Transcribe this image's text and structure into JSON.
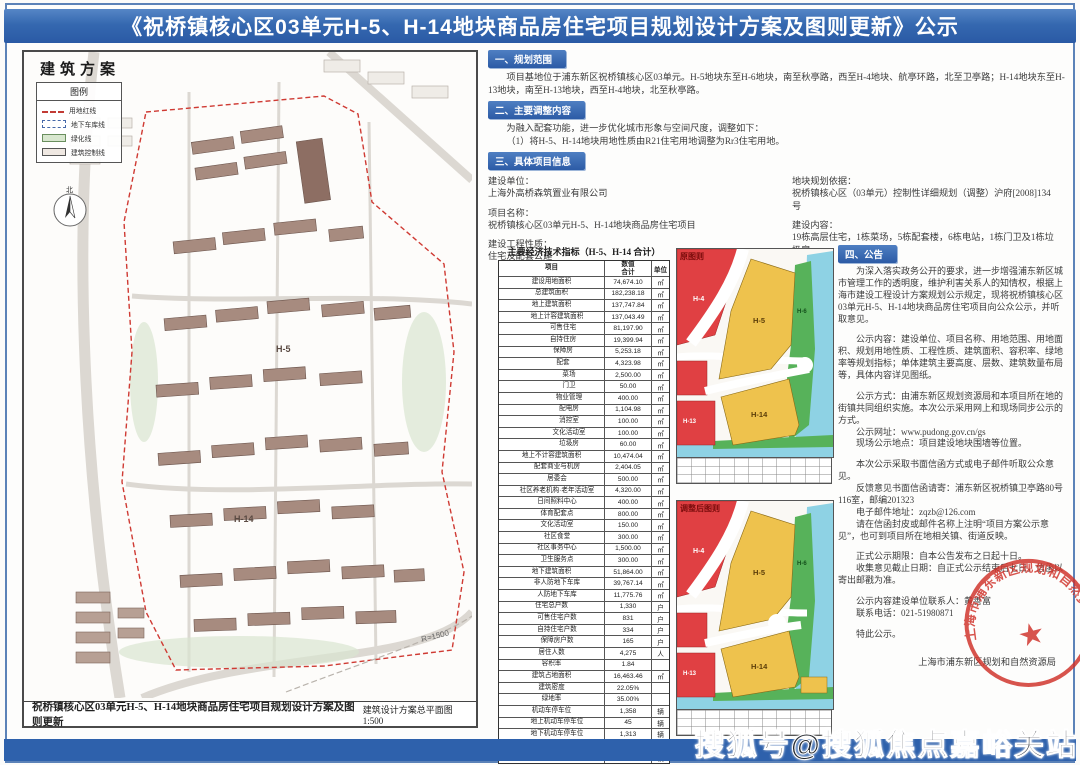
{
  "title": "《祝桥镇核心区03单元H-5、H-14地块商品房住宅项目规划设计方案及图则更新》公示",
  "plan": {
    "heading": "建筑方案",
    "legend_title": "图例",
    "legend_items": [
      {
        "label": "用地红线",
        "cls": "sw-red"
      },
      {
        "label": "地下车库线",
        "cls": "sw-blue"
      },
      {
        "label": "绿化线",
        "cls": "sw-green"
      },
      {
        "label": "建筑控制线",
        "cls": "sw-box"
      }
    ],
    "north_label": "北",
    "radius_label": "R=1500",
    "parcel_h5": "H-5",
    "parcel_h14": "H-14",
    "caption_left": "祝桥镇核心区03单元H-5、H-14地块商品房住宅项目规划设计方案及图则更新",
    "caption_right": "建筑设计方案总平面图 1:500"
  },
  "sections": {
    "s1_heading": "一、规划范围",
    "s1_body": "项目基地位于浦东新区祝桥镇核心区03单元。H-5地块东至H-6地块，南至秋亭路，西至H-4地块、航亭环路，北至卫亭路；H-14地块东至H-13地块，南至H-13地块，西至H-4地块，北至秋亭路。",
    "s2_heading": "二、主要调整内容",
    "s2_line1": "为融入配套功能，进一步优化城市形象与空间尺度，调整如下：",
    "s2_line2": "（1）将H-5、H-14地块用地性质由R21住宅用地调整为Rr3住宅用地。",
    "s3_heading": "三、具体项目信息",
    "s3_left": [
      {
        "label": "建设单位：",
        "value": "上海外高桥森筑置业有限公司"
      },
      {
        "label": "项目名称：",
        "value": "祝桥镇核心区03单元H-5、H-14地块商品房住宅项目"
      },
      {
        "label": "建设工程性质：",
        "value": "住宅及配套公建"
      }
    ],
    "s3_right": [
      {
        "label": "地块规划依据：",
        "value": "祝桥镇核心区（03单元）控制性详细规划（调整）沪府[2008]134号"
      },
      {
        "label": "建设内容：",
        "value": "19栋高层住宅，1栋菜场，5栋配套楼，6栋电站，1栋门卫及1栋垃圾房"
      }
    ],
    "s4_heading": "四、公告"
  },
  "table": {
    "title": "主要经济技术指标（H-5、H-14 合计）",
    "col_item": "项目",
    "col_value": "数值",
    "col_value2": "合计",
    "col_unit": "单位",
    "rows": [
      {
        "n": "建设用地面积",
        "v": "74,674.10",
        "u": "㎡",
        "i": "ind0"
      },
      {
        "n": "总建筑面积",
        "v": "182,238.18",
        "u": "㎡",
        "i": "ind0"
      },
      {
        "n": "地上建筑面积",
        "v": "137,747.84",
        "u": "㎡",
        "i": "ind0"
      },
      {
        "n": "地上计容建筑面积",
        "v": "137,043.49",
        "u": "㎡",
        "i": "ind1"
      },
      {
        "n": "可售住宅",
        "v": "81,197.90",
        "u": "㎡",
        "i": "ind2"
      },
      {
        "n": "自持住房",
        "v": "19,399.94",
        "u": "㎡",
        "i": "ind2"
      },
      {
        "n": "保障房",
        "v": "5,253.18",
        "u": "㎡",
        "i": "ind2"
      },
      {
        "n": "配套",
        "v": "4,323.98",
        "u": "㎡",
        "i": "ind2"
      },
      {
        "n": "菜场",
        "v": "2,500.00",
        "u": "㎡",
        "i": "ind3"
      },
      {
        "n": "门卫",
        "v": "50.00",
        "u": "㎡",
        "i": "ind3"
      },
      {
        "n": "物业管理",
        "v": "400.00",
        "u": "㎡",
        "i": "ind3"
      },
      {
        "n": "配电房",
        "v": "1,104.98",
        "u": "㎡",
        "i": "ind3"
      },
      {
        "n": "消控室",
        "v": "100.00",
        "u": "㎡",
        "i": "ind3"
      },
      {
        "n": "文化活动室",
        "v": "100.00",
        "u": "㎡",
        "i": "ind3"
      },
      {
        "n": "垃圾房",
        "v": "60.00",
        "u": "㎡",
        "i": "ind3"
      },
      {
        "n": "地上不计容建筑面积",
        "v": "10,474.04",
        "u": "㎡",
        "i": "ind0"
      },
      {
        "n": "配套商业与机房",
        "v": "2,404.05",
        "u": "㎡",
        "i": "ind1"
      },
      {
        "n": "居委会",
        "v": "500.00",
        "u": "㎡",
        "i": "ind1"
      },
      {
        "n": "社区养老机构·老年活动室",
        "v": "4,320.00",
        "u": "㎡",
        "i": "ind1"
      },
      {
        "n": "日间照料中心",
        "v": "400.00",
        "u": "㎡",
        "i": "ind1"
      },
      {
        "n": "体育配套点",
        "v": "800.00",
        "u": "㎡",
        "i": "ind1"
      },
      {
        "n": "文化活动室",
        "v": "150.00",
        "u": "㎡",
        "i": "ind1"
      },
      {
        "n": "社区食堂",
        "v": "300.00",
        "u": "㎡",
        "i": "ind1"
      },
      {
        "n": "社区事务中心",
        "v": "1,500.00",
        "u": "㎡",
        "i": "ind1"
      },
      {
        "n": "卫生服务点",
        "v": "300.00",
        "u": "㎡",
        "i": "ind1"
      },
      {
        "n": "地下建筑面积",
        "v": "51,864.00",
        "u": "㎡",
        "i": "ind0"
      },
      {
        "n": "非人防地下车库",
        "v": "39,767.14",
        "u": "㎡",
        "i": "ind1"
      },
      {
        "n": "人防地下车库",
        "v": "11,775.76",
        "u": "㎡",
        "i": "ind1"
      },
      {
        "n": "住宅总户数",
        "v": "1,330",
        "u": "户",
        "i": "ind0"
      },
      {
        "n": "可售住宅户数",
        "v": "831",
        "u": "户",
        "i": "ind1"
      },
      {
        "n": "自持住宅户数",
        "v": "334",
        "u": "户",
        "i": "ind1"
      },
      {
        "n": "保障房户数",
        "v": "165",
        "u": "户",
        "i": "ind1"
      },
      {
        "n": "居住人数",
        "v": "4,275",
        "u": "人",
        "i": "ind0"
      },
      {
        "n": "容积率",
        "v": "1.84",
        "u": "",
        "i": "ind0"
      },
      {
        "n": "建筑占地面积",
        "v": "16,463.46",
        "u": "㎡",
        "i": "ind0"
      },
      {
        "n": "建筑密度",
        "v": "22.05%",
        "u": "",
        "i": "ind0"
      },
      {
        "n": "绿地率",
        "v": "35.00%",
        "u": "",
        "i": "ind0"
      },
      {
        "n": "机动车停车位",
        "v": "1,358",
        "u": "辆",
        "i": "ind0"
      },
      {
        "n": "地上机动车停车位",
        "v": "45",
        "u": "辆",
        "i": "ind1"
      },
      {
        "n": "地下机动车停车位",
        "v": "1,313",
        "u": "辆",
        "i": "ind1"
      },
      {
        "n": "非机动车停车位",
        "v": "1,510",
        "u": "辆",
        "i": "ind0"
      },
      {
        "n": "地下非机动车停车位",
        "v": "1,510",
        "u": "辆",
        "i": "ind1"
      }
    ]
  },
  "maps": {
    "top_label": "原图则",
    "bottom_label": "调整后图则",
    "h4": "H-4",
    "h5": "H-5",
    "h6": "H-6",
    "h13": "H-13",
    "h14": "H-14"
  },
  "notice": {
    "paragraphs": [
      {
        "t": "为深入落实政务公开的要求，进一步增强浦东新区城市管理工作的透明度，维护利害关系人的知情权，根据上海市建设工程设计方案规划公示规定，现将祝桥镇核心区03单元H-5、H-14地块商品房住宅项目向公众公示，并听取意见。",
        "g": ""
      },
      {
        "t": "公示内容：建设单位、项目名称、用地范围、用地面积、规划用地性质、工程性质、建筑面积、容积率、绿地率等规划指标；单体建筑主要高度、层数、建筑数量布局等，具体内容详见图纸。",
        "g": "gap"
      },
      {
        "t": "公示方式：由浦东新区规划资源局和本项目所在地的街镇共同组织实施。本次公示采用网上和现场同步公示的方式。",
        "g": "gap"
      },
      {
        "t": "公示网址：www.pudong.gov.cn/gs",
        "g": ""
      },
      {
        "t": "现场公示地点：项目建设地块围墙等位置。",
        "g": ""
      },
      {
        "t": "本次公示采取书面信函方式或电子邮件听取公众意见。",
        "g": "gap"
      },
      {
        "t": "反馈意见书面信函请寄：浦东新区祝桥镇卫亭路80号116室，邮编201323",
        "g": ""
      },
      {
        "t": "电子邮件地址：zqzb@126.com",
        "g": ""
      },
      {
        "t": "请在信函封皮或邮件名称上注明“项目方案公示意见”，也可到项目所在地相关镇、街道反映。",
        "g": ""
      },
      {
        "t": "正式公示期限：自本公告发布之日起十日。",
        "g": "gap"
      },
      {
        "t": "收集意见截止日期：自正式公示结束后七日，信函以寄出邮戳为准。",
        "g": ""
      },
      {
        "t": "公示内容建设单位联系人：黄善富",
        "g": "gap"
      },
      {
        "t": "联系电话：021-51980871",
        "g": ""
      },
      {
        "t": "特此公示。",
        "g": "gap"
      }
    ],
    "signoff": "上海市浦东新区规划和自然资源局",
    "seal_text": "上海市浦东新区规划和自然资源局"
  },
  "watermark": "搜狐号@搜狐焦点嘉峪关站",
  "colors": {
    "accent_blue": "#2e61ac",
    "map_red": "#e04043",
    "map_yellow": "#eec24d",
    "map_green": "#57b25a",
    "map_cyan": "#8ed2e4",
    "seal_red": "#cf2f27"
  }
}
